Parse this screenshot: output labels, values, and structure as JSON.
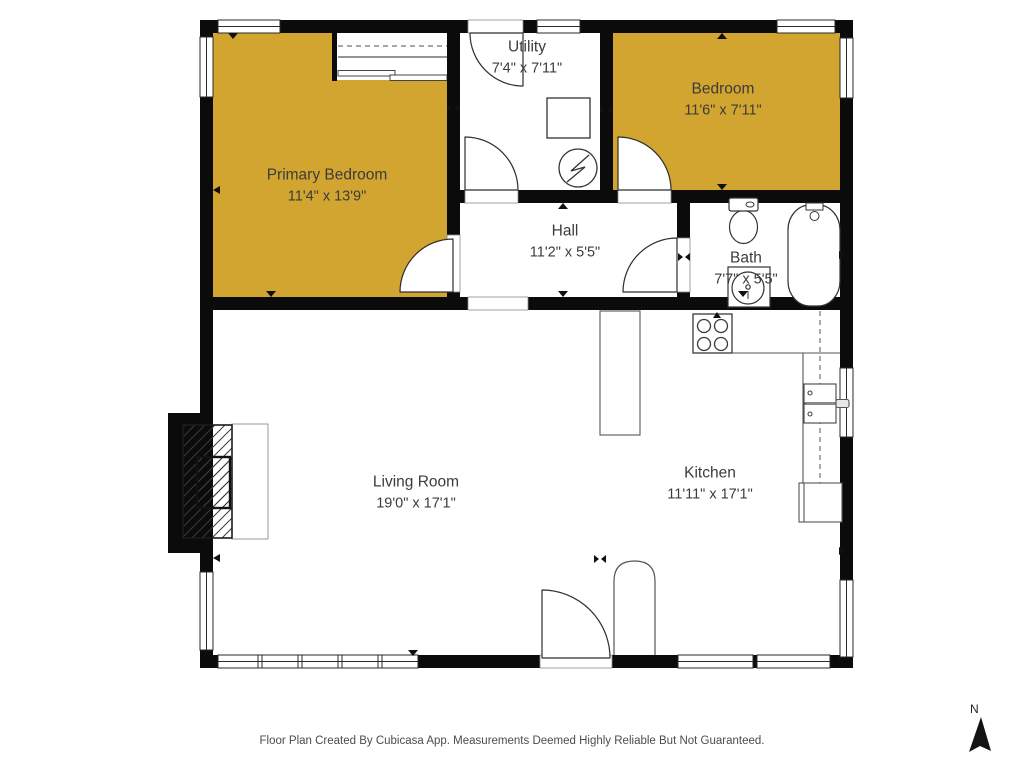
{
  "plan": {
    "footer": "Floor Plan Created By Cubicasa App. Measurements Deemed Highly Reliable But Not Guaranteed.",
    "compass_label": "N",
    "colors": {
      "highlight": "#D1A52F",
      "wall": "#0B0B0B",
      "text": "#3C3C3C"
    },
    "rooms": [
      {
        "name": "Primary Bedroom",
        "dims": "11'4\" x 13'9\"",
        "highlighted": true
      },
      {
        "name": "Utility",
        "dims": "7'4\" x 7'11\"",
        "highlighted": false
      },
      {
        "name": "Bedroom",
        "dims": "11'6\" x 7'11\"",
        "highlighted": true
      },
      {
        "name": "Hall",
        "dims": "11'2\" x 5'5\"",
        "highlighted": false
      },
      {
        "name": "Bath",
        "dims": "7'7\" x 5'5\"",
        "highlighted": false
      },
      {
        "name": "Living Room",
        "dims": "19'0\" x 17'1\"",
        "highlighted": false
      },
      {
        "name": "Kitchen",
        "dims": "11'11\" x 17'1\"",
        "highlighted": false
      }
    ],
    "fixtures": [
      "closet",
      "washer",
      "water-heater",
      "toilet",
      "bathroom-sink",
      "bathtub",
      "stove",
      "kitchen-sink",
      "counter",
      "refrigerator",
      "fireplace",
      "front-door",
      "north-arrow"
    ]
  }
}
